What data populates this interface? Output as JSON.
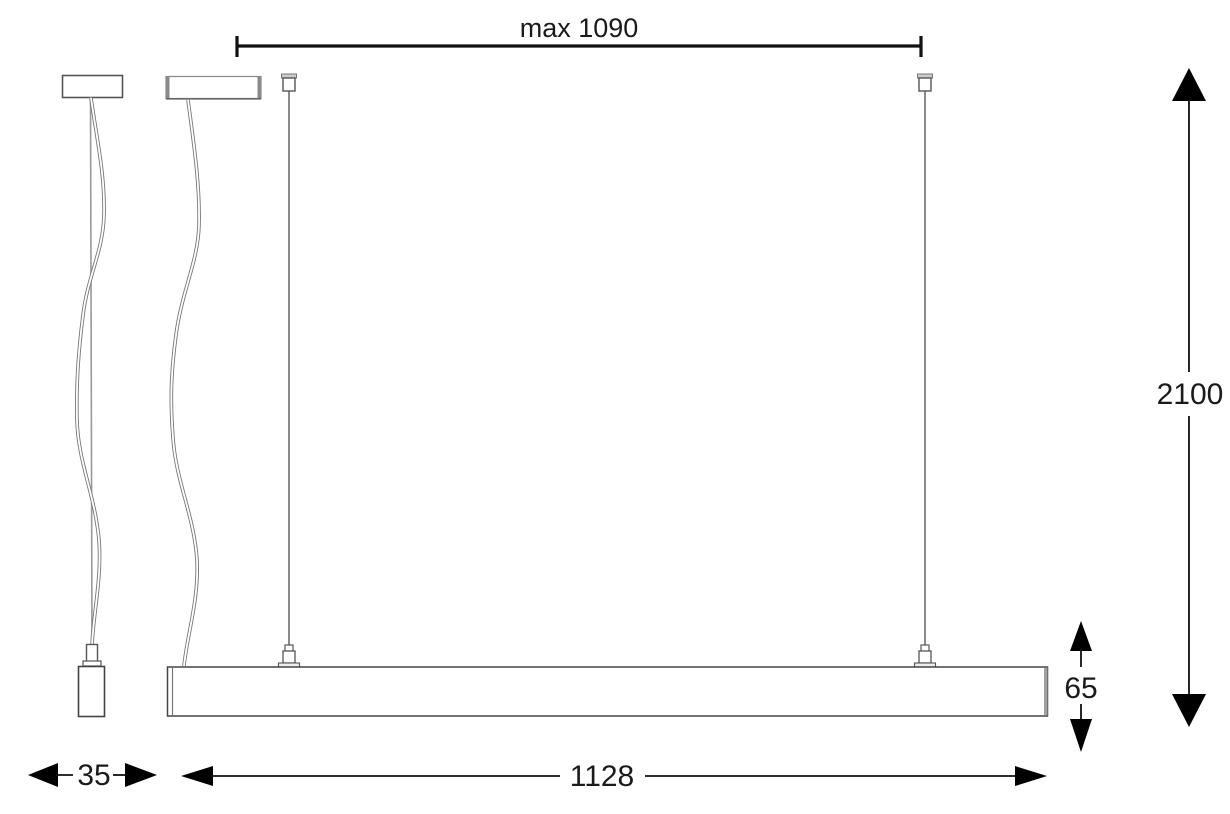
{
  "drawing": {
    "type": "pendant-luminaire-dimension-drawing",
    "dimensions": {
      "suspension_max": "max 1090",
      "overall_height": "2100",
      "bar_height": "65",
      "bar_length": "1128",
      "profile_width": "35"
    },
    "colors": {
      "dimension": "#111111",
      "outline": "#555555",
      "wire": "#8a8a8a",
      "background": "#ffffff"
    }
  }
}
